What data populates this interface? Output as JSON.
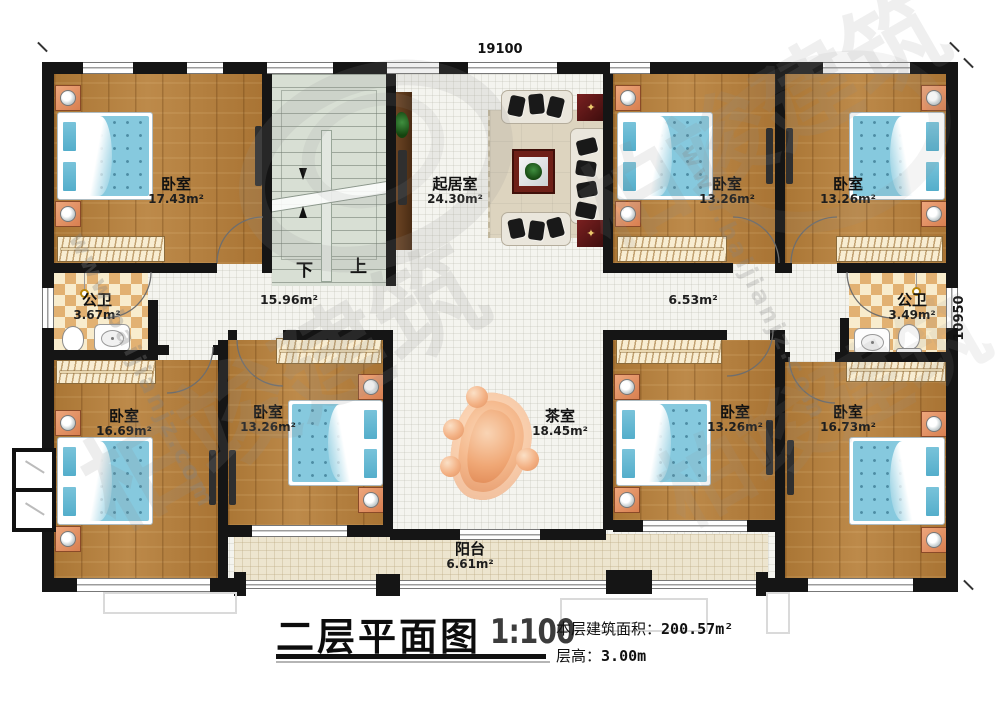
{
  "plan": {
    "dimensions": {
      "top": "19100",
      "right": "10950"
    },
    "stairs": {
      "down_label": "下",
      "up_label": "上"
    },
    "rooms": [
      {
        "name": "卧室",
        "area": "17.43m²"
      },
      {
        "name": "起居室",
        "area": "24.30m²"
      },
      {
        "name": "卧室",
        "area": "13.26m²"
      },
      {
        "name": "卧室",
        "area": "13.26m²"
      },
      {
        "name": "公卫",
        "area": "3.67m²"
      },
      {
        "name": "公卫",
        "area": "3.49m²"
      },
      {
        "name": "卧室",
        "area": "16.69m²"
      },
      {
        "name": "卧室",
        "area": "13.26m²"
      },
      {
        "name": "茶室",
        "area": "18.45m²"
      },
      {
        "name": "卧室",
        "area": "13.26m²"
      },
      {
        "name": "卧室",
        "area": "16.73m²"
      },
      {
        "name": "阳台",
        "area": "6.61m²"
      }
    ],
    "hallways": [
      {
        "area": "15.96m²"
      },
      {
        "area": "6.53m²"
      }
    ]
  },
  "title_block": {
    "title": "二层平面图",
    "scale": "1:100",
    "floor_area_label": "本层建筑面积：",
    "floor_area_value": "200.57m²",
    "floor_height_label": "层高：",
    "floor_height_value": "3.00m"
  },
  "watermark": {
    "brand": "柏竣建筑",
    "url": "www.baijianjz.com"
  }
}
